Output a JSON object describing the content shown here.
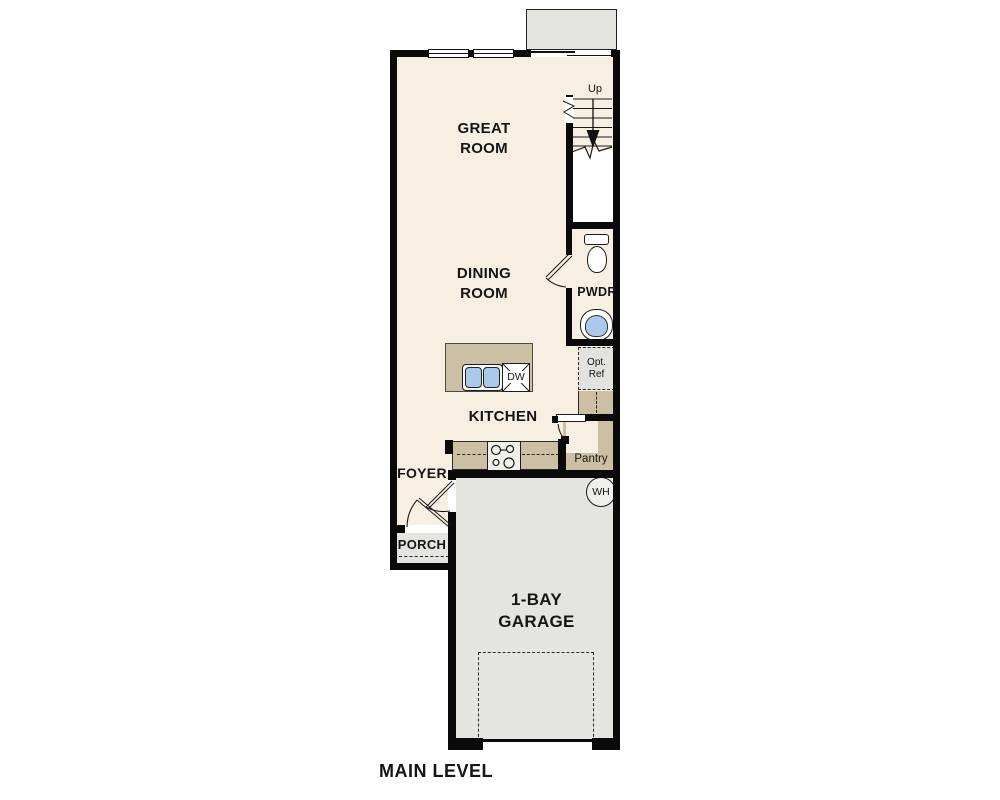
{
  "plan": {
    "level_label": "MAIN LEVEL",
    "rooms": {
      "great_room": "GREAT ROOM",
      "dining_room": "DINING ROOM",
      "kitchen": "KITCHEN",
      "foyer": "FOYER",
      "porch": "PORCH",
      "powder_room": "PWDR",
      "pantry": "Pantry",
      "garage": "1-BAY GARAGE"
    },
    "annotations": {
      "stair_direction": "Up",
      "dishwasher": "DW",
      "water_heater": "WH",
      "optional_refrigerator": "Opt. Ref"
    },
    "colors": {
      "floor": "#F7EFE2",
      "counter": "#CCBFA4",
      "garage": "#E4E4E1",
      "deck": "#E3E4E0",
      "wall": "#0A0A0A",
      "sink": "#ABCAEB"
    }
  }
}
